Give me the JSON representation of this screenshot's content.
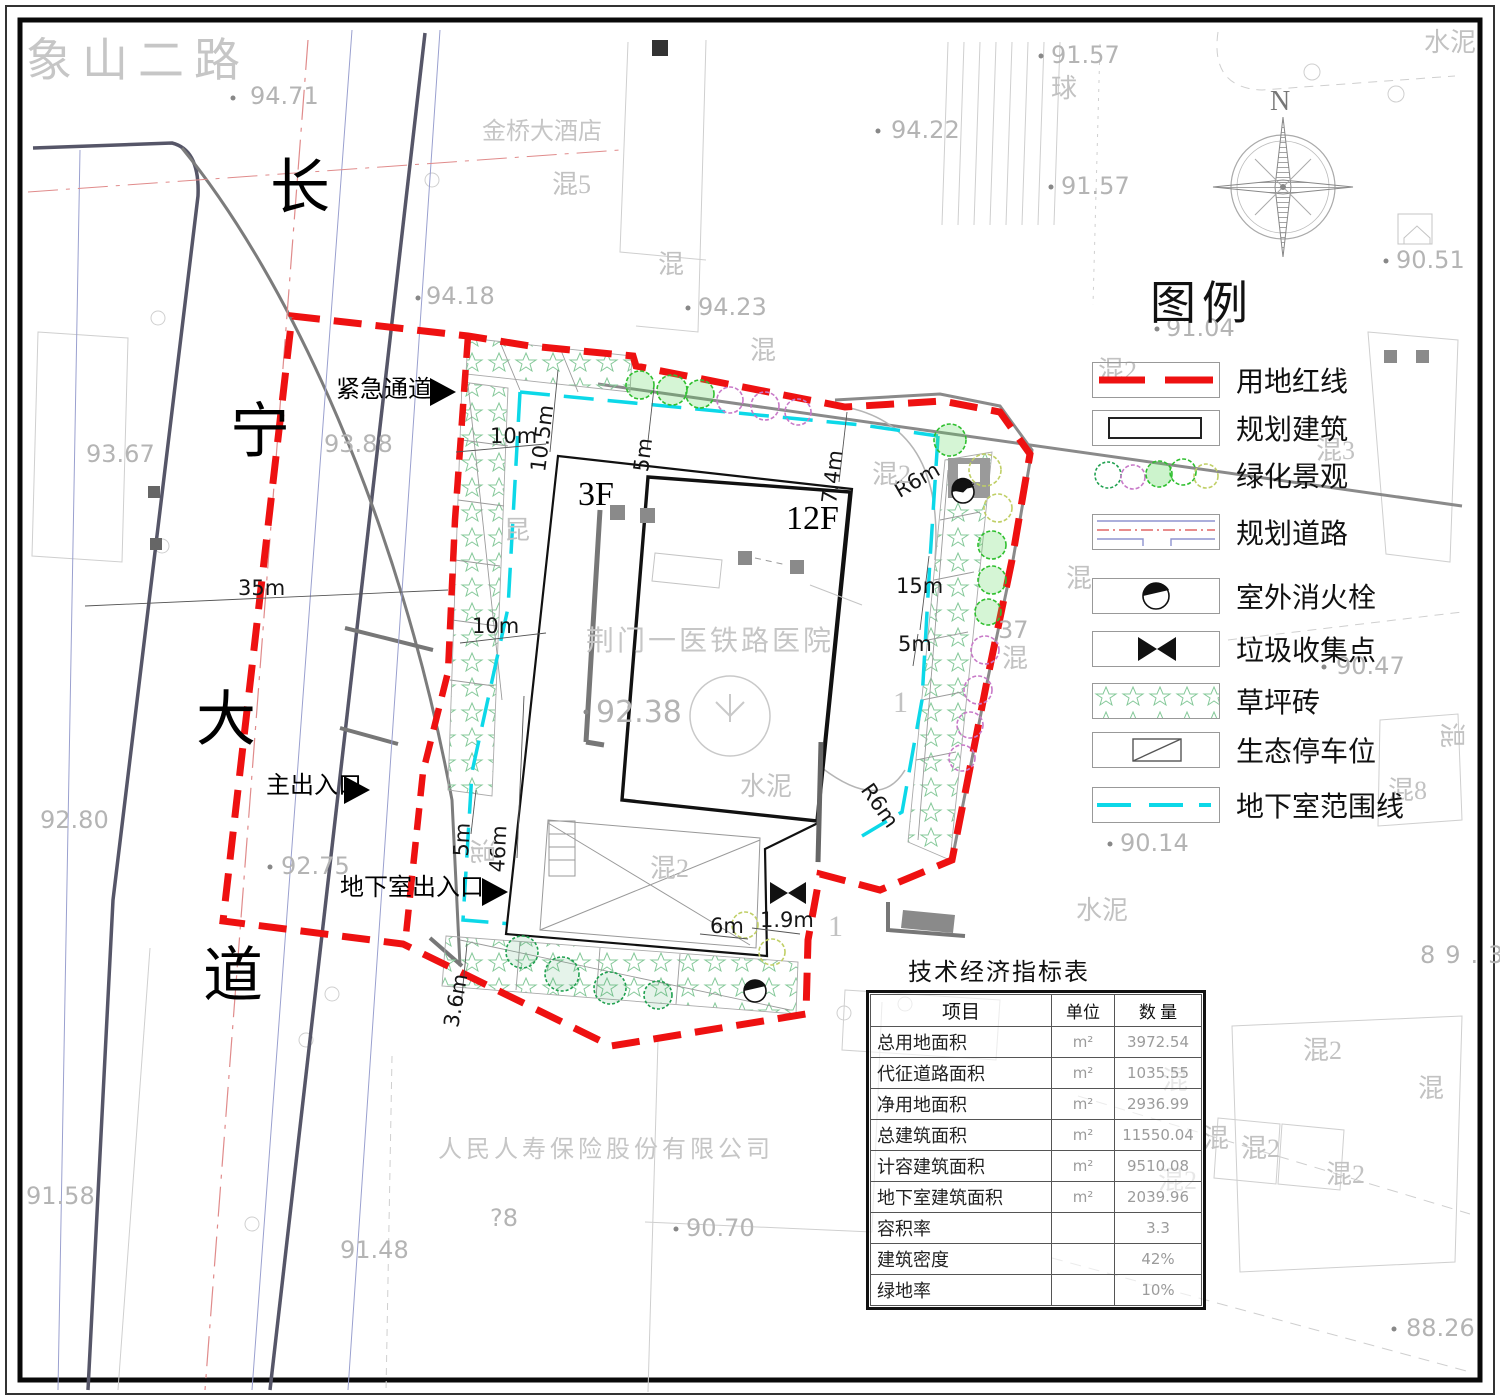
{
  "legend": {
    "title": "图例",
    "items": [
      "用地红线",
      "规划建筑",
      "绿化景观",
      "规划道路",
      "室外消火栓",
      "垃圾收集点",
      "草坪砖",
      "生态停车位",
      "地下室范围线"
    ]
  },
  "table": {
    "title": "技术经济指标表",
    "headers": [
      "项目",
      "单位",
      "数  量"
    ],
    "rows": [
      {
        "item": "总用地面积",
        "unit": "m²",
        "value": "3972.54"
      },
      {
        "item": "代征道路面积",
        "unit": "m²",
        "value": "1035.55"
      },
      {
        "item": "净用地面积",
        "unit": "m²",
        "value": "2936.99"
      },
      {
        "item": "总建筑面积",
        "unit": "m²",
        "value": "11550.04"
      },
      {
        "item": "计容建筑面积",
        "unit": "m²",
        "value": "9510.08"
      },
      {
        "item": "地下室建筑面积",
        "unit": "m²",
        "value": "2039.96"
      },
      {
        "item": "容积率",
        "unit": "",
        "value": "3.3"
      },
      {
        "item": "建筑密度",
        "unit": "",
        "value": "42%"
      },
      {
        "item": "绿地率",
        "unit": "",
        "value": "10%"
      }
    ]
  },
  "roads": {
    "xiangshan": "象山二路",
    "changning": [
      "长",
      "宁",
      "大",
      "道"
    ]
  },
  "places": {
    "hotel": "金桥大酒店",
    "hospital": "荆门一医铁路医院",
    "insurance": "人民人寿保险股份有限公司"
  },
  "site": {
    "floors_podium": "3F",
    "floors_tower": "12F",
    "emergency": "紧急通道",
    "main_entrance": "主出入口",
    "basement_entrance": "地下室出入口"
  },
  "compass": {
    "north": "N"
  },
  "dims": [
    "35m",
    "10m",
    "10.5m",
    "5m",
    "7.4m",
    "R6m",
    "10m",
    "46m",
    "15m",
    "5m",
    "5m",
    "R6m",
    "3.6m",
    "6m",
    "1.9m"
  ],
  "elevations": [
    "94.71",
    "94.18",
    "94.23",
    "94.22",
    "91.57",
    "91.57",
    "91.04",
    "90.51",
    "93.67",
    "93.88",
    "92.38",
    "92.80",
    "92.75",
    "91.58",
    "91.48",
    "90.70",
    "?8",
    "37",
    "90.47",
    "90.14",
    "89.3",
    "88.26"
  ],
  "parcels": [
    "混5",
    "混",
    "混",
    "混2",
    "混3",
    "混2",
    "昆",
    "混",
    "混",
    "混8",
    "混",
    "水泥",
    "水泥",
    "水泥",
    "球",
    "混",
    "混2",
    "混",
    "混2",
    "混",
    "混",
    "混2",
    "混2",
    "混2",
    "1",
    "1"
  ],
  "icons": {
    "north_arrow": "compass-rose",
    "fire_hydrant": "half-filled-circle",
    "waste_point": "bowtie-triangles",
    "entrance_arrow": "solid-right-triangle"
  },
  "colors": {
    "boundary_red": "#ee1111",
    "basement_cyan": "#0cd8e8",
    "tree_green": "#2fbf2f",
    "tree_magenta": "#c879c8",
    "tree_pale": "#c0cf66",
    "cad_gray": "#b4b4b4"
  }
}
